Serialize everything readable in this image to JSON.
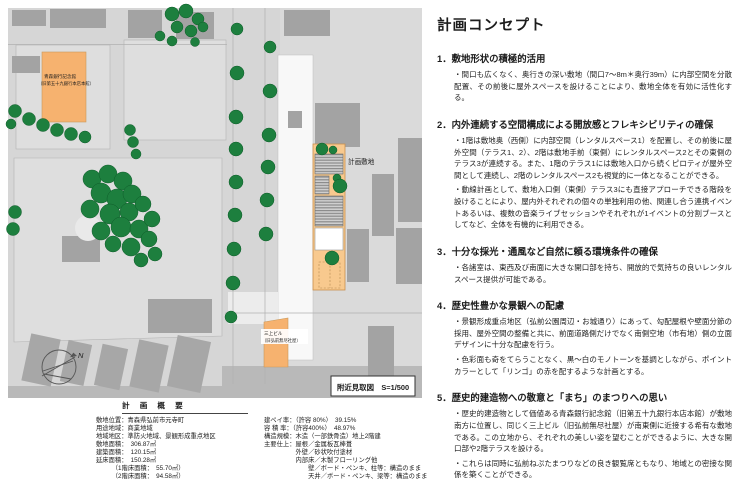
{
  "map": {
    "labels": {
      "bank_line1": "青森銀行記念館",
      "bank_line2": "（旧第五十九銀行本店本館）",
      "mikami_line1": "三上ビル",
      "mikami_line2": "（旧弘前無尽社屋）",
      "site": "計画敷地",
      "north": "N",
      "caption": "附近見取図　S=1/500"
    },
    "colors": {
      "road": "#d6d6d6",
      "parcel": "#dedede",
      "building": "#a3a3a3",
      "tree": "#1d7f3e",
      "landmark_orange": "#f6b26f",
      "site_orange": "#f8c98e"
    }
  },
  "concept": {
    "title": "計画コンセプト",
    "sections": [
      {
        "heading": "1．敷地形状の積極的活用",
        "paragraphs": [
          "・間口も広くなく、奥行きの深い敷地（間口7～8m＊奥行39m）に内部空間を分散配置、その前後に屋外スペースを設けることにより、敷地全体を有効に活性化する。"
        ]
      },
      {
        "heading": "2．内外連続する空間構成による開放感とフレキシビリティの確保",
        "paragraphs": [
          "・1階は敷地奥（西側）に内部空間（レンタルスペース1）を配置し、その前後に屋外空間（テラス1、2）、2階は敷地手前（東側）にレンタルスペース2とその東側のテラス3が連続する。また、1階のテラス1には敷地入口から続くピロティが屋外空間として連続し、2階のレンタルスペース2も視覚的に一体となることができる。",
          "・動線計画として、敷地入口側（東側）テラス3にも直接アプローチできる階段を設けることにより、屋内外それぞれの個々の単独利用の他、関連し合う連携イベントあるいは、複数の音楽ライブセッションやそれぞれが1イベントの分割ブースとしてなど、全体を有機的に利用できる。"
        ]
      },
      {
        "heading": "3．十分な採光・通風など自然に頼る環境条件の確保",
        "paragraphs": [
          "・各諸室は、東西及び南面に大きな開口部を持ち、開放的で気持ちの良いレンタルスペース提供が可能である。"
        ]
      },
      {
        "heading": "4．歴史性豊かな景観への配慮",
        "paragraphs": [
          "・景観形成重点地区（弘前公園周辺・お城通り）にあって、勾配屋根や壁面分節の採用、屋外空間の整備と共に、前面道路側だけでなく南側空地（市有地）側の立面デザインに十分な配慮を行う。",
          "・色彩面も奇をてらうことなく、黒～白のモノトーンを基調としながら、ポイントカラーとして「リンゴ」の赤を配するような計画とする。"
        ]
      },
      {
        "heading": "5．歴史的建造物への敬意と「まち」のまつりへの思い",
        "paragraphs": [
          "・歴史的建造物として価値ある青森銀行記念館（旧第五十九銀行本店本館）が敷地南方に位置し、同じく三上ビル（旧弘前無尽社屋）が南東側に近接する希有な敷地である。この立地から、それぞれの美しい姿を望むことができるように、大きな開口部や2階テラスを設ける。",
          "・これらは同時に弘前ねぷたまつりなどの良き観覧席ともなり、地域との密接な関係を築くことができる。"
        ]
      }
    ]
  },
  "overview": {
    "title": "計 画 概 要",
    "left": [
      "敷地位置：青森県弘前市元寺町",
      "用途地域：商業地域",
      "地域地区：準防火地域、景観形成重点地区",
      "敷地面積：　306.87㎡",
      "建築面積：　120.15㎡",
      "延床面積：　150.28㎡",
      "　　　（1階床面積：　55.70㎡）",
      "　　　（2階床面積：　94.58㎡）"
    ],
    "right": [
      "建ペイ率：（許容 80%）　39.15%",
      "容 積 率：（許容400%）　48.97%",
      "構造規模：木造（一部鉄骨造）地上2階建",
      "主要仕上：屋根／金属板瓦棒葺",
      "　　　　　外壁／砂状吹付塗材",
      "　　　　　内部床／木製フローリング他",
      "　　　　　　　壁／ボード・ペンキ、柱等：構造のまま",
      "　　　　　　　天井／ボード・ペンキ、梁等：構造のまま"
    ]
  }
}
